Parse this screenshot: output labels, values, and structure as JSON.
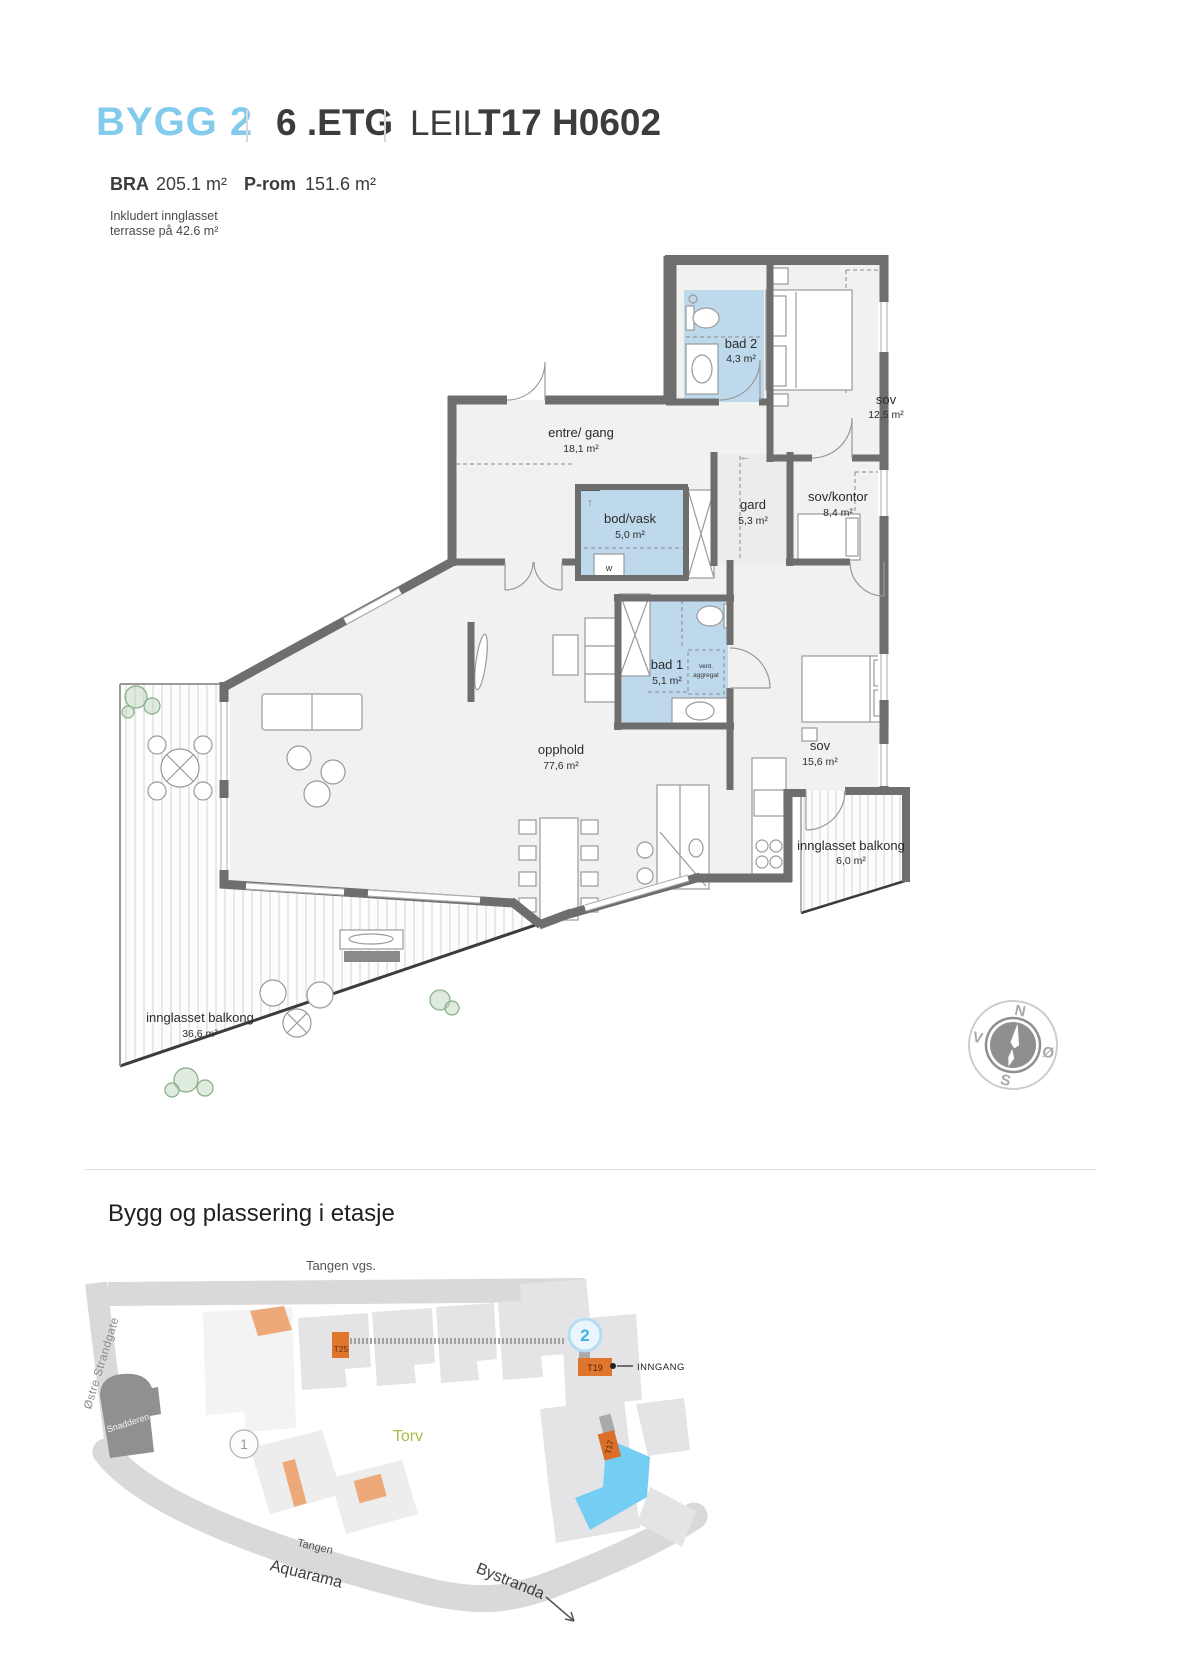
{
  "header": {
    "building": "BYGG 2",
    "floor": "6 .ETG",
    "unit_label": "LEIL.",
    "unit_id": "T17 H0602",
    "bra_label": "BRA",
    "bra_value": "205.1 m²",
    "prom_label": "P-rom",
    "prom_value": "151.6 m²",
    "note_line1": "Inkludert innglasset",
    "note_line2": "terrasse på 42.6 m²"
  },
  "floorplan": {
    "rooms": [
      {
        "id": "bad-2",
        "name": "bad 2",
        "area": "4,3 m²"
      },
      {
        "id": "sov-12",
        "name": "sov",
        "area": "12,5 m²"
      },
      {
        "id": "entre-gang",
        "name": "entre/ gang",
        "area": "18,1 m²"
      },
      {
        "id": "bod-vask",
        "name": "bod/vask",
        "area": "5,0 m²"
      },
      {
        "id": "gard",
        "name": "gard",
        "area": "5,3 m²"
      },
      {
        "id": "sov-kontor",
        "name": "sov/kontor",
        "area": "8,4 m²"
      },
      {
        "id": "bad-1",
        "name": "bad 1",
        "area": "5,1 m²"
      },
      {
        "id": "sov-15",
        "name": "sov",
        "area": "15,6 m²"
      },
      {
        "id": "opphold",
        "name": "opphold",
        "area": "77,6 m²"
      },
      {
        "id": "balkong-6",
        "name": "innglasset balkong",
        "area": "6,0 m²"
      },
      {
        "id": "balkong-36",
        "name": "innglasset balkong",
        "area": "36,6 m²"
      }
    ],
    "annotations": {
      "w": "w",
      "vent_line1": "vent.",
      "vent_line2": "aggregat",
      "arrow_left": "←",
      "arrow_up": "↑"
    },
    "compass": {
      "north": "N",
      "east": "Ø",
      "south": "S",
      "west": "V"
    }
  },
  "sitemap": {
    "title": "Bygg og plassering i etasje",
    "streets": {
      "tangen_vgs": "Tangen vgs.",
      "ostre_strandgate": "Østre Strandgate",
      "tangen": "Tangen",
      "aquarama": "Aquarama",
      "bystranda": "Bystranda"
    },
    "places": {
      "snadderen": "Snadderen",
      "torv": "Torv"
    },
    "markers": {
      "t25": "T25",
      "t19": "T19",
      "t17": "T17",
      "inngang": "INNGANG",
      "building_1": "1",
      "building_2": "2"
    }
  },
  "colors": {
    "accent_blue": "#82cbec",
    "wet_room": "#bfd9ec",
    "wall": "#6e6e6e",
    "map_orange": "#e0752e",
    "map_orange_light": "#eda977",
    "map_blue": "#74cdf3",
    "torv_green": "#a4bd44",
    "circle2_blue": "#3fb3e8"
  }
}
